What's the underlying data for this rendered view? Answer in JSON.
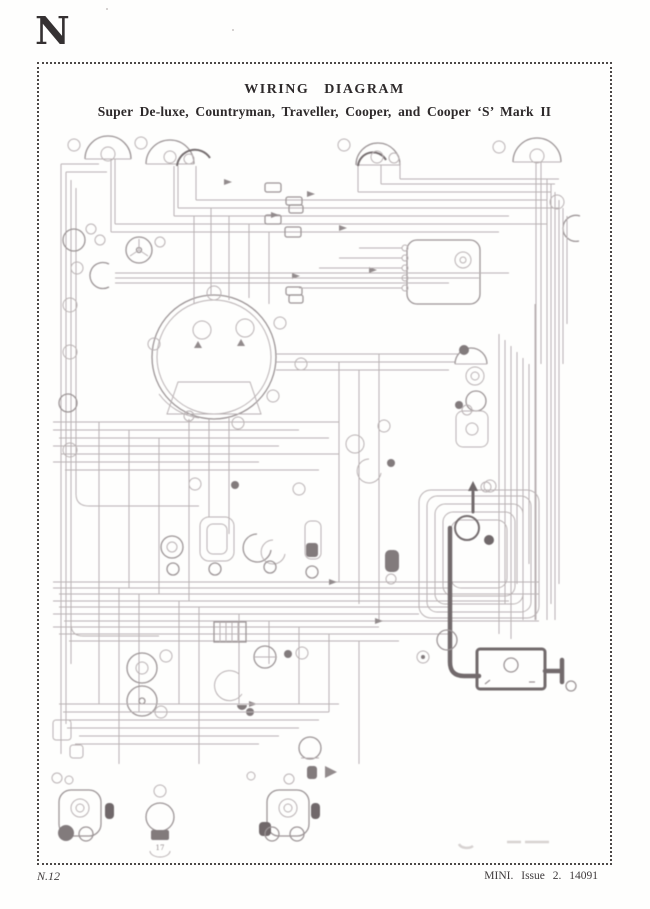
{
  "page": {
    "section_letter": "N"
  },
  "figure": {
    "title": "WIRING  DIAGRAM",
    "subtitle": "Super De-luxe, Countryman, Traveller, Cooper, and Cooper ‘S’ Mark II",
    "callout_17": "17"
  },
  "footer": {
    "page_number": "N.12",
    "right": "MINI.  Issue 2.  14091"
  },
  "colors": {
    "ink": "#353132",
    "border_dots": "#4c4847",
    "diagram_light": "#b6aeb0",
    "diagram_dark": "#6b6365"
  }
}
